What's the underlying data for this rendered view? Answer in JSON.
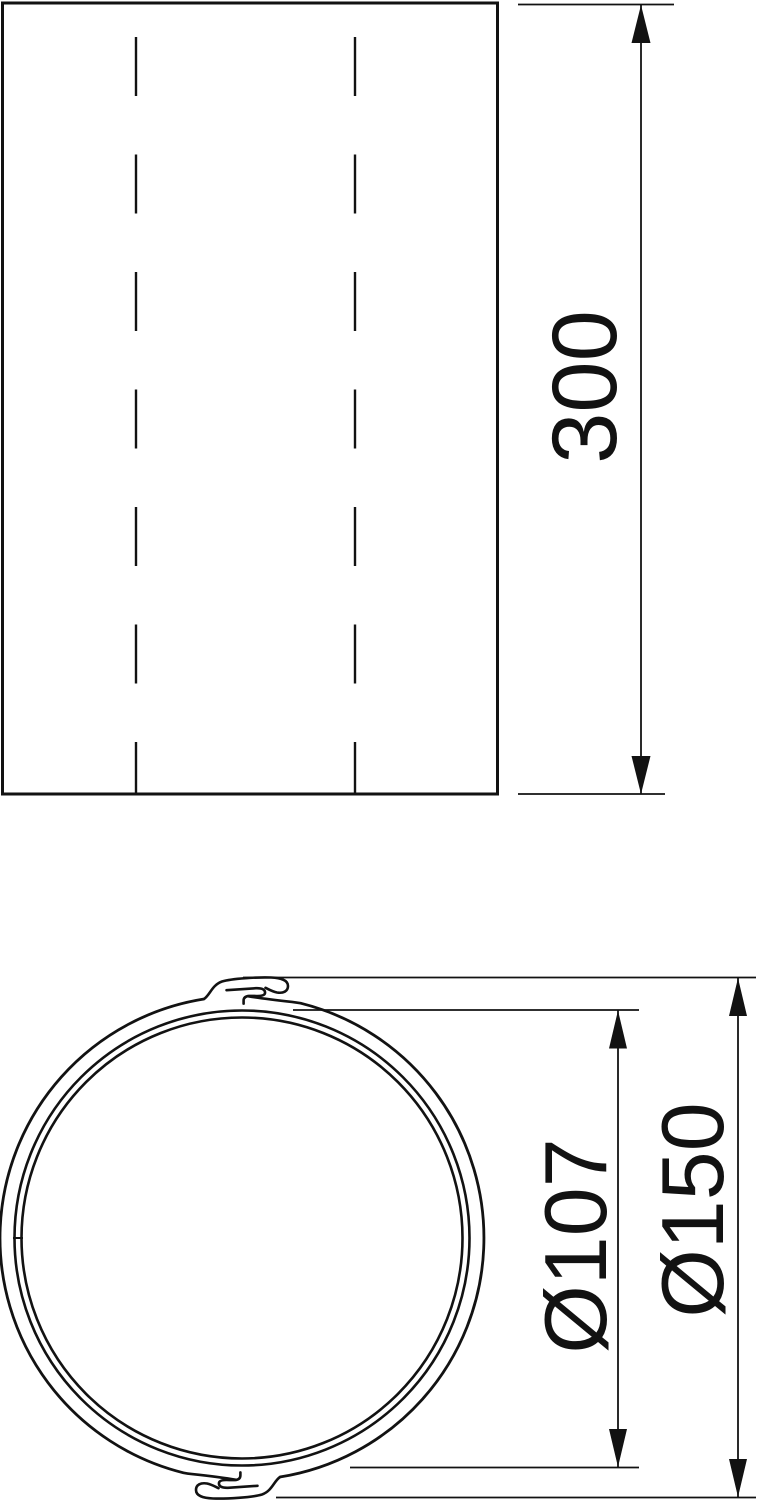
{
  "drawing": {
    "type": "technical-dimension-drawing",
    "background_color": "#ffffff",
    "line_color": "#121212",
    "side_view": {
      "length_dimension_label": "300"
    },
    "front_view": {
      "inner_diameter_label": "Ø107",
      "outer_diameter_label": "Ø150"
    }
  }
}
